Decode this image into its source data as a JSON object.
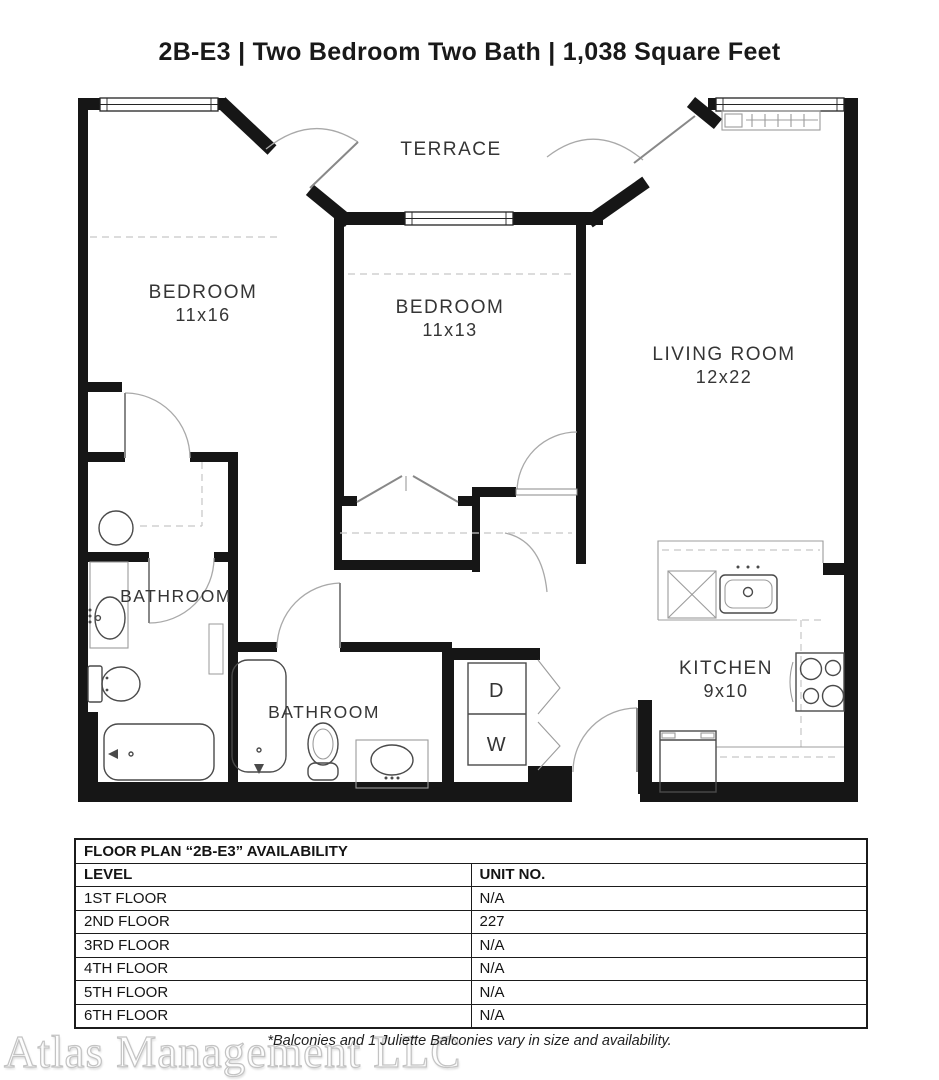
{
  "page": {
    "title": "2B-E3 | Two Bedroom Two Bath | 1,038 Square Feet"
  },
  "floor_plan": {
    "labels": {
      "terrace": "TERRACE",
      "bedroom1": {
        "name": "BEDROOM",
        "dims": "11x16"
      },
      "bedroom2": {
        "name": "BEDROOM",
        "dims": "11x13"
      },
      "living_room": {
        "name": "LIVING ROOM",
        "dims": "12x22"
      },
      "bathroom1": "BATHROOM",
      "bathroom2": "BATHROOM",
      "kitchen": {
        "name": "KITCHEN",
        "dims": "9x10"
      },
      "dryer": "D",
      "washer": "W"
    }
  },
  "availability_table": {
    "title": "FLOOR PLAN “2B-E3” AVAILABILITY",
    "columns": [
      "LEVEL",
      "UNIT NO."
    ],
    "rows": [
      {
        "level": "1ST FLOOR",
        "unit": "N/A"
      },
      {
        "level": "2ND FLOOR",
        "unit": "227"
      },
      {
        "level": "3RD FLOOR",
        "unit": "N/A"
      },
      {
        "level": "4TH FLOOR",
        "unit": "N/A"
      },
      {
        "level": "5TH FLOOR",
        "unit": "N/A"
      },
      {
        "level": "6TH FLOOR",
        "unit": "N/A"
      }
    ]
  },
  "footer": {
    "watermark": "Atlas Management LLC",
    "disclaimer": "*Balconies and 1 Juliette Balconies vary in size and availability."
  },
  "colors": {
    "wall": "#161616",
    "fixture": "#4a4a4a",
    "light_gray": "#c6c6c6",
    "label": "#353535"
  }
}
